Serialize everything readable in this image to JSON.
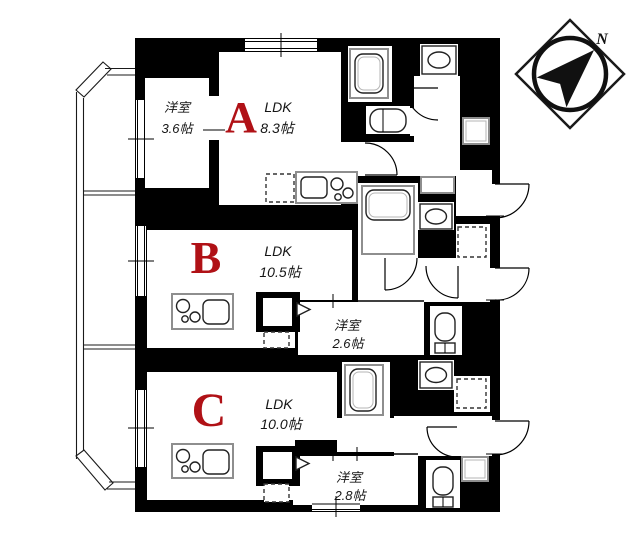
{
  "plan": {
    "compass_north": "N",
    "units": [
      {
        "letter": "A",
        "ldk_label": "LDK",
        "ldk_size": "8.3帖",
        "bedroom_label": "洋室",
        "bedroom_size": "3.6帖"
      },
      {
        "letter": "B",
        "ldk_label": "LDK",
        "ldk_size": "10.5帖",
        "bedroom_label": "洋室",
        "bedroom_size": "2.6帖"
      },
      {
        "letter": "C",
        "ldk_label": "LDK",
        "ldk_size": "10.0帖",
        "bedroom_label": "洋室",
        "bedroom_size": "2.8帖"
      }
    ],
    "colors": {
      "unit_letter": "#b01116",
      "wall": "#000000",
      "background": "#ffffff"
    }
  }
}
